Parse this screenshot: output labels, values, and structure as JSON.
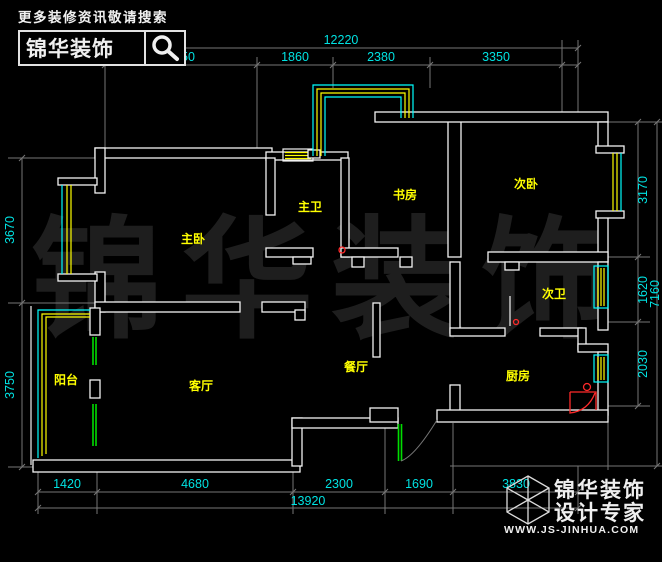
{
  "header": {
    "tagline": "更多装修资讯敬请搜索",
    "brand": "锦华装饰"
  },
  "footer": {
    "brand_line1": "锦华装饰",
    "brand_line2": "设计专家",
    "website": "WWW.JS-JINHUA.COM"
  },
  "watermark": {
    "text": "锦华装饰"
  },
  "rooms": {
    "master_bedroom": "主卧",
    "master_bath": "主卫",
    "study": "书房",
    "second_bedroom": "次卧",
    "second_bath": "次卫",
    "dining": "餐厅",
    "kitchen": "厨房",
    "living": "客厅",
    "balcony": "阳台"
  },
  "dimensions": {
    "top": {
      "overall": "12220",
      "segments": [
        "4050",
        "1860",
        "2380",
        "3350"
      ]
    },
    "bottom": {
      "overall": "13920",
      "segments": [
        "1420",
        "4680",
        "2300",
        "1690",
        "3830"
      ]
    },
    "left": {
      "segments": [
        "3670",
        "3750"
      ]
    },
    "right": {
      "overall": "7160",
      "segments": [
        "3170",
        "1620",
        "2030"
      ]
    }
  },
  "colors": {
    "background": "#000000",
    "wall": "#f2f2f2",
    "dimension_text": "#00e2e2",
    "room_label": "#ffff00",
    "window_cyan": "#00ffff",
    "window_yellow": "#ffff00",
    "door_green": "#00dd00",
    "symbol_red": "#ff2a2a"
  }
}
